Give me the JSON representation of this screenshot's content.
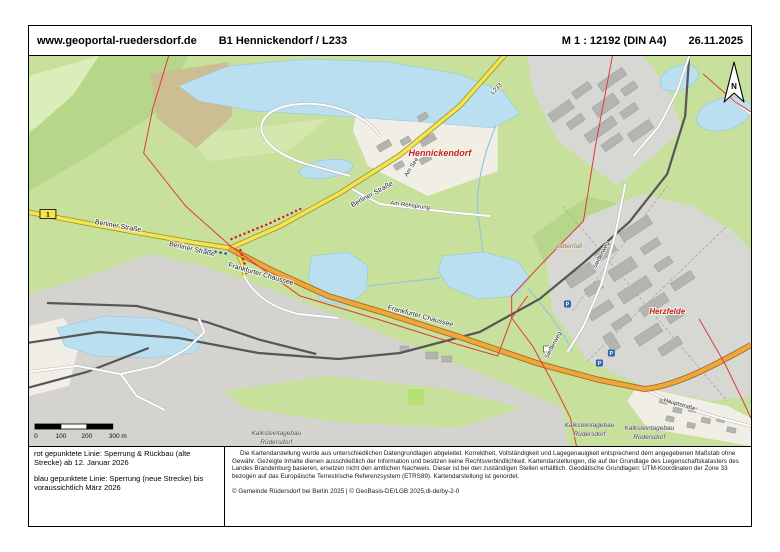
{
  "header": {
    "site": "www.geoportal-ruedersdorf.de",
    "title": "B1 Hennickendorf / L233",
    "scale": "M 1 : 12192 (DIN A4)",
    "date": "26.11.2025"
  },
  "legend": {
    "line1": "rot   gepunktete Linie: Sperrung & Rückbau (alte Strecke) ab 12. Januar 2026",
    "line2": "blau gepunktete Linie: Sperrung (neue Strecke) bis voraussichtlich März 2026"
  },
  "disclaimer": {
    "text": "Die Kartendarstellung wurde aus unterschiedlichen Datengrundlagen abgeleitet. Korrektheit, Vollständigkeit und Lagegenauigkeit entsprechend dem angegebenen Maßstab ohne Gewähr. Gezeigte Inhalte dienen ausschließlich der Information und besitzen keine Rechtsverbindlichkeit. Kartendarstellungen, die auf der Grundlage des Liegenschaftskatasters des Landes Brandenburg basieren, ersetzen nicht den amtlichen Nachweis. Dieser ist bei den zuständigen Stellen erhältlich. Geodätische Grundlagen: UTM-Koordinaten der Zone 33 bezogen auf das Europäische Terrestrische Referenzsystem (ETRS89). Kartendarstellung ist genordet.",
    "copyright": "© Gemeinde Rüdersdorf bei Berlin 2025 | © GeoBasis-DE/LGB 2025,dl-de/by-2-0"
  },
  "scalebar": {
    "labels": [
      "0",
      "100",
      "200",
      "300 m"
    ]
  },
  "north": "N",
  "map": {
    "colors": {
      "field_green": "#c7e09b",
      "water_blue": "#b9dff1",
      "industrial_gray": "#d7d7d4",
      "road_yellow": "#f4e44f",
      "road_orange": "#efa73d",
      "boundary_red": "#e03a3a",
      "closure_red_dotted": "#e01818",
      "closure_blue_dotted": "#2438c8",
      "place_label_red": "#c2251e"
    },
    "labels": [
      {
        "text": "Hennickendorf",
        "x": 412,
        "y": 100,
        "rot": 0,
        "cls": "place"
      },
      {
        "text": "Herzfelde",
        "x": 640,
        "y": 258,
        "rot": 0,
        "cls": "place-sm"
      },
      {
        "text": "Berliner Straße",
        "x": 89,
        "y": 172,
        "rot": 10,
        "cls": "street"
      },
      {
        "text": "Berliner Straße",
        "x": 163,
        "y": 195,
        "rot": 13,
        "cls": "street"
      },
      {
        "text": "Berliner Straße",
        "x": 345,
        "y": 140,
        "rot": -29,
        "cls": "street"
      },
      {
        "text": "Frankfurter Chaussee",
        "x": 232,
        "y": 220,
        "rot": 16,
        "cls": "street"
      },
      {
        "text": "Frankfurter Chaussee",
        "x": 392,
        "y": 262,
        "rot": 15,
        "cls": "street"
      },
      {
        "text": "Am See",
        "x": 385,
        "y": 112,
        "rot": -58,
        "cls": "street-sm"
      },
      {
        "text": "Am Rehsprung",
        "x": 382,
        "y": 151,
        "rot": 7,
        "cls": "street-sm"
      },
      {
        "text": "L233",
        "x": 470,
        "y": 34,
        "rot": -47,
        "cls": "street-sm"
      },
      {
        "text": "Siedlerweg",
        "x": 575,
        "y": 200,
        "rot": -62,
        "cls": "street-sm"
      },
      {
        "text": "Siedlerweg",
        "x": 527,
        "y": 290,
        "rot": -62,
        "cls": "street-sm"
      },
      {
        "text": "Hauptstraße",
        "x": 652,
        "y": 350,
        "rot": 16,
        "cls": "street-sm"
      },
      {
        "text": "Vattenfall",
        "x": 541,
        "y": 192,
        "rot": 0,
        "cls": "area-brown"
      },
      {
        "text": "Kalksteintagebau",
        "x": 248,
        "y": 379,
        "rot": 0,
        "cls": "area-gray"
      },
      {
        "text": "Rüdersdorf",
        "x": 248,
        "y": 388,
        "rot": 0,
        "cls": "area-gray"
      },
      {
        "text": "Kalksteintagebau",
        "x": 562,
        "y": 371,
        "rot": 0,
        "cls": "area-gray"
      },
      {
        "text": "Rüdersdorf",
        "x": 562,
        "y": 380,
        "rot": 0,
        "cls": "area-gray"
      },
      {
        "text": "Kalksteintagebau",
        "x": 622,
        "y": 374,
        "rot": 0,
        "cls": "area-gray"
      },
      {
        "text": "Rüdersdorf",
        "x": 622,
        "y": 383,
        "rot": 0,
        "cls": "area-gray"
      }
    ],
    "markers": [
      {
        "type": "route-badge",
        "label": "1",
        "x": 19,
        "y": 158
      },
      {
        "type": "parking",
        "label": "P",
        "x": 540,
        "y": 248
      },
      {
        "type": "parking",
        "label": "P",
        "x": 572,
        "y": 307
      },
      {
        "type": "parking",
        "label": "P",
        "x": 584,
        "y": 297
      },
      {
        "type": "poi",
        "label": "",
        "x": 519,
        "y": 293
      }
    ]
  }
}
